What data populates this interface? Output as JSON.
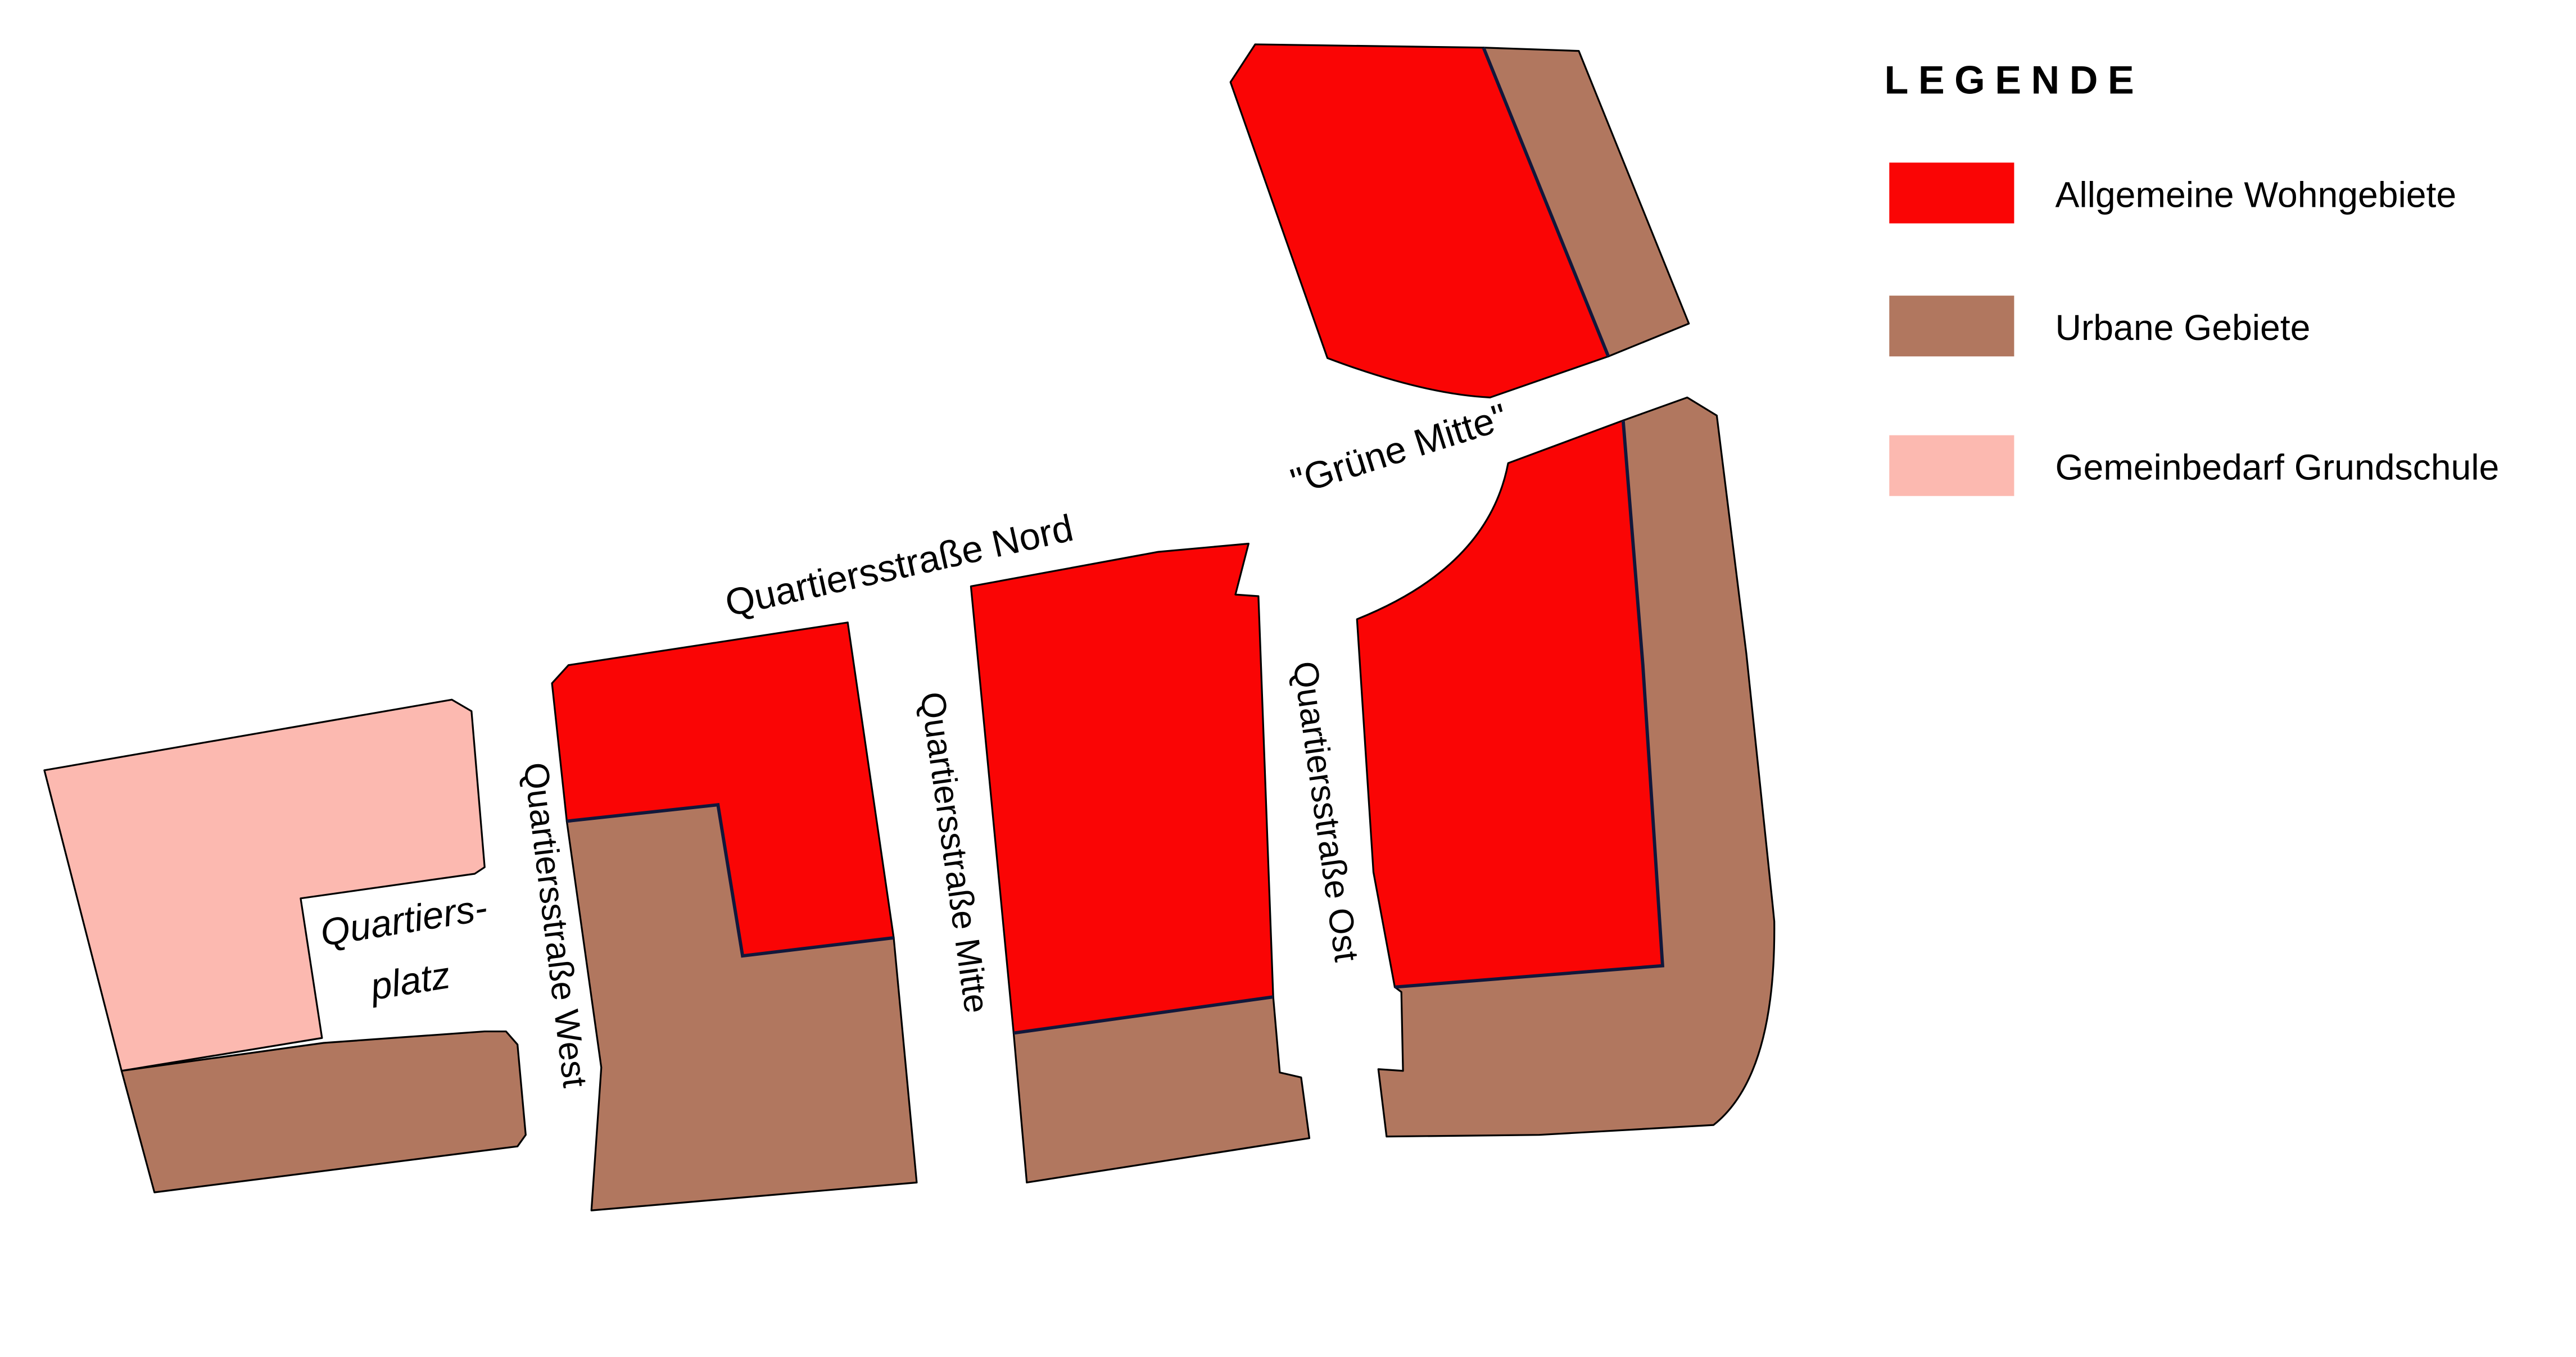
{
  "colors": {
    "residential_red": "#FA0505",
    "urban_brown": "#B1775F",
    "school_pink": "#FCB9B0",
    "divider_navy": "#11173B",
    "outline_black": "#000000",
    "background_white": "#FFFFFF",
    "text_black": "#000000"
  },
  "map": {
    "street_labels": {
      "nord": "Quartiersstraße Nord",
      "west": "Quartiersstraße West",
      "mitte": "Quartiersstraße Mitte",
      "ost": "Quartiersstraße Ost",
      "gruene_mitte": "\"Grüne Mitte\"",
      "platz_line1": "Quartiers-",
      "platz_line2": "platz"
    },
    "areas": [
      {
        "id": "school-pink",
        "type": "Gemeinbedarf Grundschule"
      },
      {
        "id": "school-block-urban",
        "type": "Urbane Gebiete"
      },
      {
        "id": "west-block-residential",
        "type": "Allgemeine Wohngebiete"
      },
      {
        "id": "west-block-urban",
        "type": "Urbane Gebiete"
      },
      {
        "id": "mitte-block-residential",
        "type": "Allgemeine Wohngebiete"
      },
      {
        "id": "mitte-block-urban",
        "type": "Urbane Gebiete"
      },
      {
        "id": "ost-block-residential",
        "type": "Allgemeine Wohngebiete"
      },
      {
        "id": "ost-block-urban",
        "type": "Urbane Gebiete"
      },
      {
        "id": "north-block-residential",
        "type": "Allgemeine Wohngebiete"
      },
      {
        "id": "north-block-urban",
        "type": "Urbane Gebiete"
      }
    ]
  },
  "legend": {
    "title": "LEGENDE",
    "items": [
      {
        "label": "Allgemeine Wohngebiete",
        "color": "#FA0505"
      },
      {
        "label": "Urbane Gebiete",
        "color": "#B1775F"
      },
      {
        "label": "Gemeinbedarf Grundschule",
        "color": "#FCB9B0"
      }
    ]
  }
}
